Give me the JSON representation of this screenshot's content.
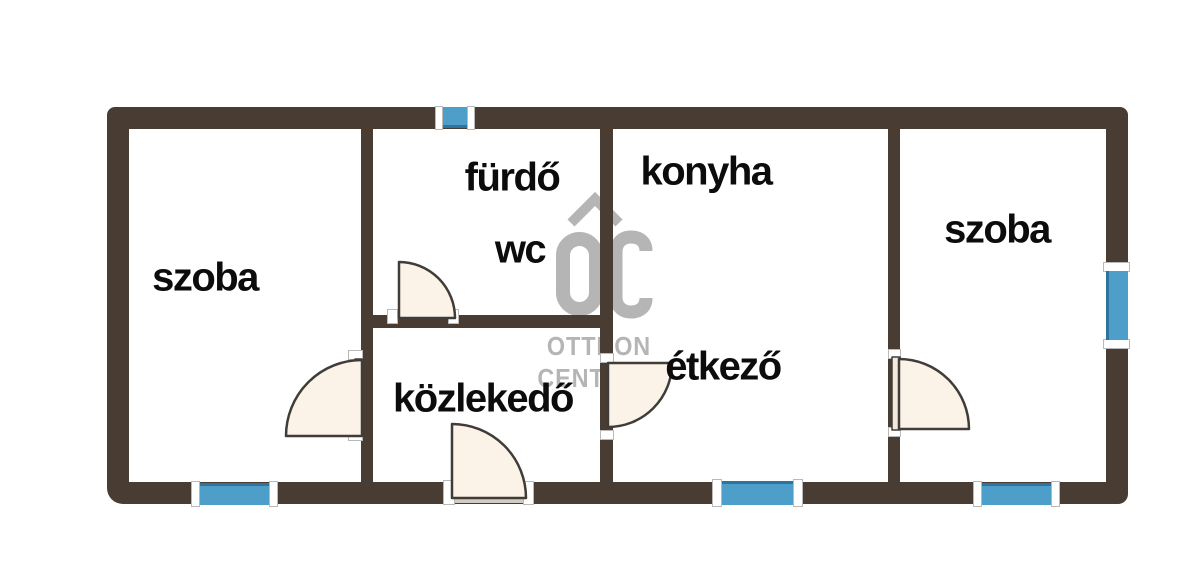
{
  "watermark": {
    "monogram": "OC",
    "line1": "OTTHON",
    "line2": "CENTRUM",
    "color": "#b5b5b5"
  },
  "rooms": [
    {
      "id": "szoba-left",
      "label": "szoba"
    },
    {
      "id": "furdo",
      "label": "fürdő"
    },
    {
      "id": "wc",
      "label": "wc"
    },
    {
      "id": "konyha",
      "label": "konyha"
    },
    {
      "id": "etkezo",
      "label": "étkező"
    },
    {
      "id": "kozlekedo",
      "label": "közlekedő"
    },
    {
      "id": "szoba-right",
      "label": "szoba"
    }
  ],
  "colors": {
    "wall": "#493c33",
    "window_blue": "#4d9ec9",
    "window_edge": "#2e749e",
    "door_fill": "#fbf3e8",
    "door_outline": "#403d39",
    "threshold": "#d5ccc1",
    "jamb_white": "#ffffff",
    "label_black": "#0c0c0c",
    "watermark_gray": "#b5b5b5",
    "background": "#ffffff"
  }
}
